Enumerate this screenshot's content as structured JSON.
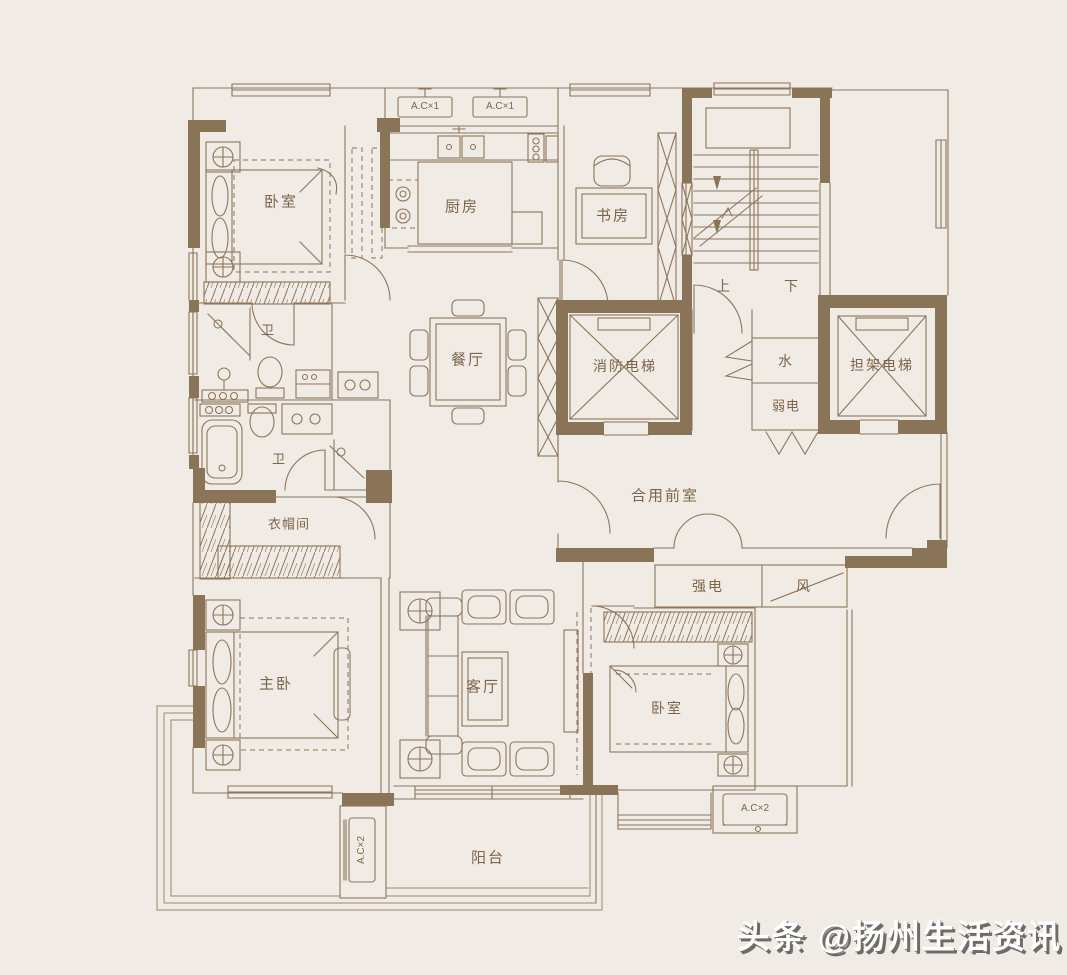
{
  "palette": {
    "background": "#f0ebe5",
    "wall_fill": "#8a7458",
    "line": "#8d765a",
    "label": "#7d6549",
    "watermark_fill": "#ffffff",
    "watermark_shadow": "#6f6c68"
  },
  "rooms": {
    "bedroom": "卧室",
    "kitchen": "厨房",
    "study": "书房",
    "bath": "卫",
    "dining": "餐厅",
    "fire_elevator": "消防电梯",
    "water_shaft": "水",
    "weak_power": "弱电",
    "stretcher_elevator": "担架电梯",
    "stairs_up": "上",
    "stairs_down": "下",
    "shared_lobby": "合用前室",
    "strong_power": "强电",
    "vent_shaft": "风",
    "cloakroom": "衣帽间",
    "master_bedroom": "主卧",
    "living_room": "客厅",
    "balcony": "阳台"
  },
  "equipment": {
    "ac_single": "A.C×1",
    "ac_double": "A.C×2"
  },
  "watermark": {
    "text": "头条 @扬州生活资讯"
  }
}
